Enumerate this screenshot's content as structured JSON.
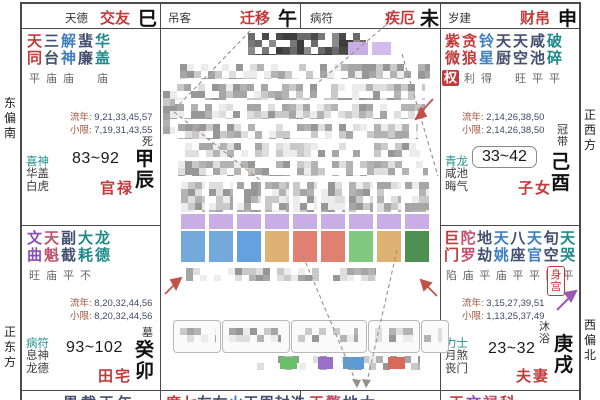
{
  "app": {
    "kind": "ziwei-doushu-chart",
    "center_censored": true
  },
  "labels": {
    "liunian": "流年",
    "xiaoxian": "小限"
  },
  "directions": {
    "left_top": "东偏南",
    "left_bottom": "正东方",
    "right_top": "正西方",
    "right_bottom": "西偏北"
  },
  "top_row": [
    {
      "god": "天德",
      "palace": "交友",
      "branch": "巳"
    },
    {
      "god": "吊客",
      "palace": "迁移",
      "branch": "午"
    },
    {
      "god": "病符",
      "palace": "疾厄",
      "branch": "未"
    },
    {
      "god": "岁建",
      "palace": "财帛",
      "branch": "申"
    }
  ],
  "palaces": [
    {
      "key": "chen",
      "stem_branch": "甲辰",
      "changsheng": "死",
      "palace_name": "官禄",
      "age_range": "83~92",
      "age_boxed": false,
      "stars": [
        {
          "n": "天同",
          "c": "major",
          "b": "平"
        },
        {
          "n": "三台",
          "c": "navy",
          "b": "庙"
        },
        {
          "n": "解神",
          "c": "blue",
          "b": "庙"
        },
        {
          "n": "蜚廉",
          "c": "navy",
          "b": ""
        },
        {
          "n": "华盖",
          "c": "teal",
          "b": "庙"
        }
      ],
      "liunian": "9,21,33,45,57",
      "xiaoxian": "7,19,31,43,55",
      "gods": [
        "喜神",
        "华盖",
        "白虎"
      ]
    },
    {
      "key": "you",
      "stem_branch": "己酉",
      "changsheng": "冠带",
      "palace_name": "子女",
      "age_range": "33~42",
      "age_boxed": true,
      "hua_badge": "权",
      "stars": [
        {
          "n": "紫微",
          "c": "major",
          "b": "旺"
        },
        {
          "n": "贪狼",
          "c": "major",
          "b": "利"
        },
        {
          "n": "铃星",
          "c": "blue",
          "b": "得"
        },
        {
          "n": "天厨",
          "c": "navy",
          "b": ""
        },
        {
          "n": "天空",
          "c": "navy",
          "b": "旺"
        },
        {
          "n": "咸池",
          "c": "navy",
          "b": "平"
        },
        {
          "n": "破碎",
          "c": "teal",
          "b": "平"
        }
      ],
      "liunian": "2,14,26,38,50",
      "xiaoxian": "2,14,26,38,50",
      "gods": [
        "青龙",
        "咸池",
        "晦气"
      ]
    },
    {
      "key": "mao",
      "stem_branch": "癸卯",
      "changsheng": "墓",
      "palace_name": "田宅",
      "age_range": "93~102",
      "age_boxed": false,
      "stars": [
        {
          "n": "文曲",
          "c": "purple",
          "b": "旺"
        },
        {
          "n": "天魁",
          "c": "rose",
          "b": "庙"
        },
        {
          "n": "副截",
          "c": "navy",
          "b": "平"
        },
        {
          "n": "大耗",
          "c": "teal",
          "b": "不"
        },
        {
          "n": "龙德",
          "c": "teal",
          "b": ""
        }
      ],
      "liunian": "8,20,32,44,56",
      "xiaoxian": "8,20,32,44,56",
      "gods": [
        "病符",
        "息神",
        "龙德"
      ]
    },
    {
      "key": "xu",
      "stem_branch": "庚戌",
      "changsheng": "沐浴",
      "palace_name": "夫妻",
      "age_range": "23~32",
      "age_boxed": false,
      "body_badge": "身宫",
      "stars": [
        {
          "n": "巨门",
          "c": "major",
          "b": "陷"
        },
        {
          "n": "陀罗",
          "c": "rose",
          "b": "庙"
        },
        {
          "n": "地劫",
          "c": "navy",
          "b": "平"
        },
        {
          "n": "天姚",
          "c": "blue",
          "b": "庙"
        },
        {
          "n": "八座",
          "c": "navy",
          "b": "平"
        },
        {
          "n": "天官",
          "c": "blue",
          "b": "平"
        },
        {
          "n": "旬空",
          "c": "navy",
          "b": "陷"
        },
        {
          "n": "天哭",
          "c": "teal",
          "b": "平"
        }
      ],
      "liunian": "3,15,27,39,51",
      "xiaoxian": "1,13,25,37,49",
      "gods": [
        "力士",
        "月煞",
        "丧门"
      ]
    }
  ],
  "bottom_row": [
    {
      "chars": [
        [
          "恩",
          "navy"
        ],
        [
          "截",
          "navy"
        ],
        [
          "天",
          "navy"
        ],
        [
          "年",
          "navy"
        ]
      ]
    },
    {
      "chars": [
        [
          "廉",
          "major"
        ],
        [
          "七",
          "major"
        ],
        [
          "左",
          "navy"
        ],
        [
          "右",
          "navy"
        ],
        [
          "火",
          "blue"
        ],
        [
          "天",
          "navy"
        ],
        [
          "周",
          "navy"
        ],
        [
          "封",
          "navy"
        ],
        [
          "诰",
          "navy"
        ]
      ]
    },
    {
      "chars": [
        [
          "天",
          "major"
        ],
        [
          "擎",
          "rose"
        ],
        [
          "地",
          "navy"
        ],
        [
          "太",
          "navy"
        ]
      ]
    },
    {
      "chars": [
        [
          "天",
          "major"
        ],
        [
          "文",
          "purple"
        ],
        [
          "禄",
          "rose"
        ],
        [
          "科",
          "major"
        ]
      ]
    }
  ],
  "colors": {
    "major": "#c23b3b",
    "navy": "#44506e",
    "teal": "#1f8a8a",
    "blue": "#3f7fc0",
    "purple": "#8a4fb5",
    "rose": "#c0506e",
    "palace_name": "#c23b3b",
    "liunian_label": "#a1543c",
    "numbers": "#3d4a66",
    "censor_chips": [
      "#5b9bd5",
      "#6abf69",
      "#d9a45b",
      "#d96a5b",
      "#9b6fc9",
      "#c9aee6"
    ]
  }
}
